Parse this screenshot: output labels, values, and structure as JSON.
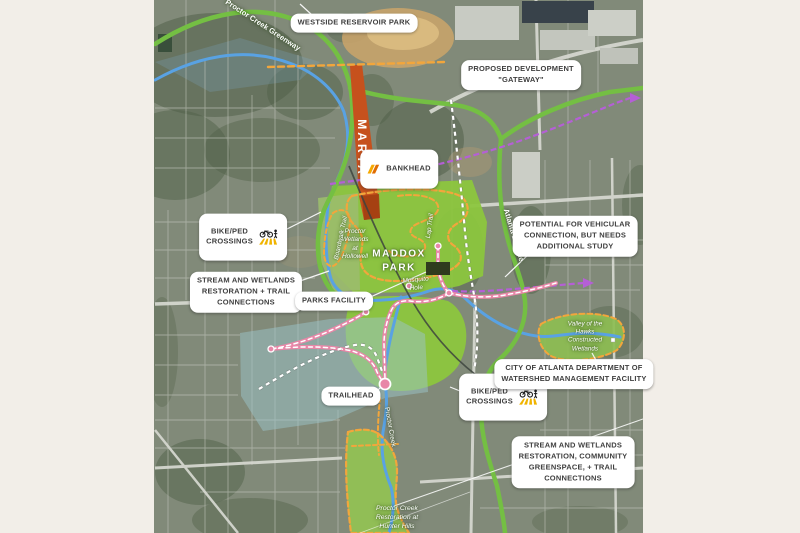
{
  "page": {
    "background_color": "#f2eee8"
  },
  "map": {
    "callouts": {
      "westside_reservoir_park": "WESTSIDE RESERVOIR PARK",
      "proposed_development": "PROPOSED DEVELOPMENT\n\"GATEWAY\"",
      "bankhead": "BANKHEAD",
      "bike_ped_crossings_nw": "BIKE/PED\nCROSSINGS",
      "potential_vehicular": "POTENTIAL FOR VEHICULAR\nCONNECTION, BUT NEEDS\nADDITIONAL STUDY",
      "stream_wetlands_west": "STREAM AND WETLANDS\nRESTORATION + TRAIL\nCONNECTIONS",
      "parks_facility": "PARKS FACILITY",
      "trailhead": "TRAILHEAD",
      "bike_ped_crossings_se": "BIKE/PED\nCROSSINGS",
      "watershed_facility": "CITY OF ATLANTA DEPARTMENT OF\nWATERSHED MANAGEMENT FACILITY",
      "stream_wetlands_south": "STREAM AND WETLANDS\nRESTORATION, COMMUNITY\nGREENSPACE, + TRAIL\nCONNECTIONS"
    },
    "place_labels": {
      "marta": "MARTA",
      "maddox_park": "MADDOX\nPARK",
      "proctor_wetlands": "Proctor\nWetlands\nat\nHollowell",
      "boardwalk_trail": "Boardwalk Trail",
      "lap_trail": "Lap Trail",
      "mosquito_hole": "Mosquito\nHole",
      "atlanta_beltline": "Atlanta Beltline",
      "proctor_creek_greenway": "Proctor Creek Greenway",
      "proctor_creek": "Proctor Creek",
      "valley_of_the_hawks": "Valley of the\nHawks\nConstructed\nWetlands",
      "hunter_hills": "Proctor Creek\nRestoration at\nHunter Hills"
    },
    "icons": {
      "bankhead_icon": "marta-logo-icon",
      "bike_ped_icon": "bike-pedestrian-crossing-icon"
    },
    "legend_colors": {
      "greenway_trail_green": "#74bf43",
      "creek_blue": "#59a2e3",
      "marta_corridor_orange_red": "#c6511d",
      "park_greenspace": "#8cc63e",
      "proposed_trail_orange": "#f2a63c",
      "transit_purple": "#b55fd6",
      "pedestrian_trail_pink": "#e887a8",
      "wetland_overlay_teal": "#9cc4c9",
      "callout_background": "#ffffff",
      "callout_text": "#3f3f3f"
    }
  }
}
